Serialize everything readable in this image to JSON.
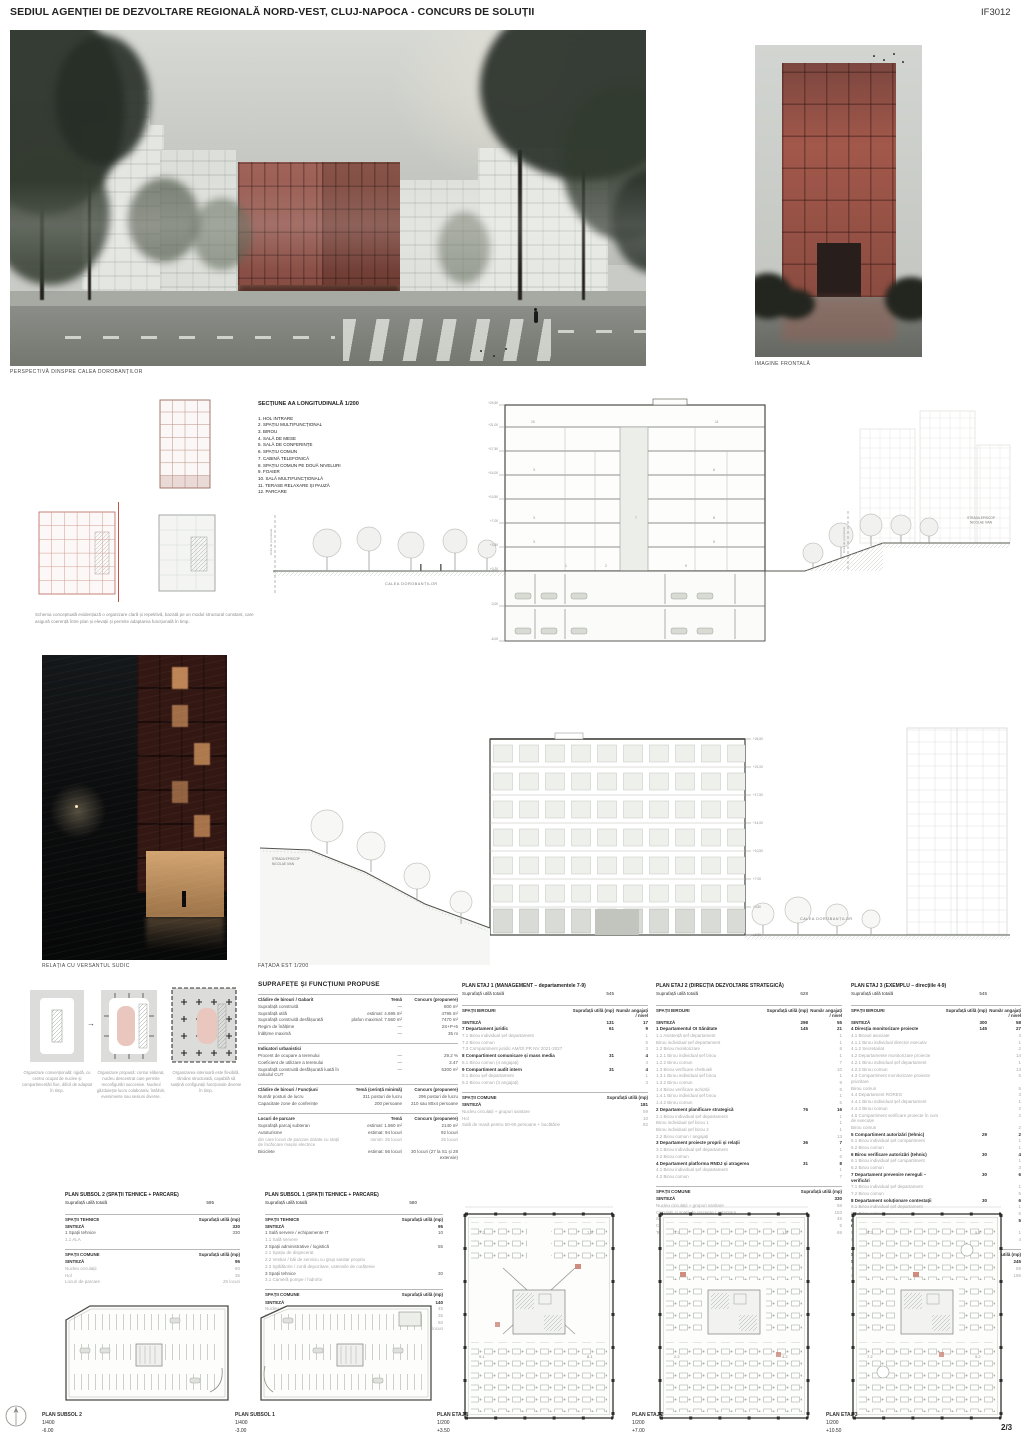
{
  "header": {
    "title": "SEDIUL AGENȚIEI DE DEZVOLTARE REGIONALĂ NORD-VEST, CLUJ-NAPOCA - CONCURS DE SOLUȚII",
    "code": "IF3012"
  },
  "captions": {
    "perspective": "PERSPECTIVĂ DINSPRE CALEA DOROBANȚILOR",
    "frontal": "IMAGINE FRONTALĂ",
    "versant": "RELAȚIA CU VERSANTUL SUDIC",
    "fatada": "FAȚADA EST 1/200"
  },
  "palette": {
    "brick_red": "#8e4a3e",
    "brick_red_front": "#a2584b",
    "night_window": "#bd8455",
    "drawing_grey": "#55584f",
    "schema_red": "#c0746a",
    "diagram_pink": "#e9c7be"
  },
  "section": {
    "title": "SECȚIUNE AA LONGITUDINALĂ 1/200",
    "legend": [
      "1. HOL INTRARE",
      "2. SPAȚIU MULTIFUNCȚIONAL",
      "3. BIROU",
      "4. SALĂ DE MESE",
      "5. SALĂ DE CONFERINȚE",
      "6. SPAȚIU COMUN",
      "7. CABINĂ TELEFONICĂ",
      "8. SPAȚIU COMUN PE DOUĂ NIVELURI",
      "9. FOAIER",
      "10. SALĂ MULTIFUNCȚIONALĂ",
      "11. TERASE RELAXARE ȘI PAUZĂ",
      "12. PARCARE"
    ],
    "street_left": "CALEA DOROBANȚILOR",
    "street_right_l1": "STRADA EPISCOP",
    "street_right_l2": "NICOLAE IVAN",
    "property_label": "limită de proprietate",
    "levels": [
      "+24,50",
      "+21,00",
      "+17,50",
      "+14,00",
      "+10,50",
      "+7,00",
      "+3,50",
      "+0,20",
      "-3,00",
      "-6,00"
    ]
  },
  "facade": {
    "street_left_l1": "STRADA EPISCOP",
    "street_left_l2": "NICOLAE IVAN",
    "street_right": "CALEA DOROBANȚILOR",
    "levels": [
      "+24,50",
      "+21,00",
      "+17,50",
      "+14,00",
      "+10,50",
      "+7,00",
      "+3,50",
      "±0,00"
    ]
  },
  "concept_text": "Schema conceptuală evidențiază o organizare clară și repetitivă, bazată pe un modul structural constant, care asigură coerență între plan și elevații și permite adaptarea funcțională în timp.",
  "diagrams": {
    "d1": "Organizare convențională: rigidă, cu centru ocupat de nuclee și compartimentări fixe, dificil de adaptat în timp.",
    "d2": "Organizare propusă: contur eliberat, nucleu descentrat care permite reconfigurări succesive. Nucleul găzduiește lucru colaborativ, întâlniri, evenimente sau sesiuni diverse.",
    "d3": "Organizarea interioară este flexibilă, rămâne structurată, capabilă să susțină configurații funcționale diverse în timp."
  },
  "suprafete": {
    "title": "SUPRAFEȚE ȘI FUNCȚIUNI PROPUSE",
    "sections": [
      {
        "h": [
          "Clădire de birouri / Gabarit",
          "Temă",
          "Concurs (propunere)"
        ],
        "rows": [
          {
            "c": [
              "Suprafață construită",
              "—",
              "800 m²"
            ]
          },
          {
            "c": [
              "Suprafață utilă",
              "estimat: 4.695 m²",
              "4795 m²"
            ]
          },
          {
            "c": [
              "Suprafață construită desfășurată",
              "plafon maximal: 7.560 m²",
              "7470 m²"
            ]
          },
          {
            "c": [
              "Regim de înălțime",
              "—",
              "2S+P+6"
            ]
          },
          {
            "c": [
              "Înălțime maximă",
              "—",
              "35 m"
            ]
          }
        ]
      },
      {
        "h": [
          "Indicatori urbanistici",
          "",
          ""
        ],
        "rows": [
          {
            "c": [
              "Procent de ocupare a terenului",
              "—",
              "29.2 %"
            ]
          },
          {
            "c": [
              "Coeficient de utilizare a terenului",
              "—",
              "2.47"
            ]
          },
          {
            "c": [
              "Suprafață construită desfășurată luată în calculul CUT",
              "—",
              "6300 m²"
            ]
          }
        ]
      },
      {
        "h": [
          "Clădire de birouri / Funcțiuni",
          "Temă (cerință minimă)",
          "Concurs (propunere)"
        ],
        "rows": [
          {
            "c": [
              "Număr posturi de lucru",
              "311 posturi de lucru",
              "296 posturi de lucru"
            ]
          },
          {
            "c": [
              "Capacitate zone de conferințe",
              "200 persoane",
              "210 sau 80x4 persoane"
            ]
          }
        ]
      },
      {
        "h": [
          "Locuri de parcare",
          "Temă",
          "Concurs (propunere)"
        ],
        "rows": [
          {
            "c": [
              "Suprafață parcaj subteran",
              "estimat: 1.860 m²",
              "2140 m²"
            ]
          },
          {
            "c": [
              "Autoturisme",
              "estimat: 94 locuri",
              "92 locuri"
            ]
          },
          {
            "c": [
              "din care locuri de parcare dotate cu stații de încărcare mașini electrice",
              "minim: 25 locuri",
              "25 locuri"
            ],
            "dim": true
          },
          {
            "c": [
              "Biciclete",
              "estimat: 56 locuri",
              "30 locuri (27 la S1 și 28 extensie)"
            ]
          }
        ]
      }
    ]
  },
  "etaj1": {
    "title": "PLAN ETAJ 1 (MANAGEMENT – departamentele 7-9)",
    "total_label": "Suprafață utilă totală",
    "total": "545",
    "birouri_label": "SPAȚII BIROURI",
    "comune_label": "SPAȚII COMUNE",
    "col_mp": "Suprafață utilă (mp)",
    "col_nr": "Număr angajați / nivel",
    "birouri": [
      {
        "c": [
          "SINTEZĂ",
          "131",
          "17"
        ],
        "b": true
      },
      {
        "c": [
          "7 Departament juridic",
          "61",
          "9"
        ],
        "b": true
      },
      {
        "c": [
          "7.1 Birou individual șef departament",
          "",
          "1"
        ],
        "dim": true
      },
      {
        "c": [
          "7.2 Birou comun",
          "",
          "5"
        ],
        "dim": true
      },
      {
        "c": [
          "7.3 Compartiment juridic AM/OI PR NV 2021-2027",
          "",
          "3"
        ],
        "dim": true
      },
      {
        "c": [
          "8 Compartiment comunicare și mass media",
          "31",
          "4"
        ],
        "b": true
      },
      {
        "c": [
          "8.1 Birou comun (4 angajați)",
          "",
          "4"
        ],
        "dim": true
      },
      {
        "c": [
          "9 Compartiment audit intern",
          "31",
          "4"
        ],
        "b": true
      },
      {
        "c": [
          "9.1 Birou șef departament",
          "",
          "1"
        ],
        "dim": true
      },
      {
        "c": [
          "9.2 Birou comun (3 angajați)",
          "",
          "3"
        ],
        "dim": true
      }
    ],
    "comune": [
      {
        "c": [
          "SINTEZĂ",
          "181"
        ],
        "b": true
      },
      {
        "c": [
          "Nucleu circulații + grupuri sanitare",
          "59"
        ],
        "dim": true
      },
      {
        "c": [
          "Hol",
          "10"
        ],
        "dim": true
      },
      {
        "c": [
          "Sală de masă pentru 50-60 persoane + bucătărie",
          "82"
        ],
        "dim": true
      }
    ]
  },
  "etaj2": {
    "title": "PLAN ETAJ 2 (DIRECȚIA DEZVOLTARE STRATEGICĂ)",
    "total_label": "Suprafață utilă totală",
    "total": "628",
    "birouri_label": "SPAȚII BIROURI",
    "comune_label": "SPAȚII COMUNE",
    "col_mp": "Suprafață utilă (mp)",
    "col_nr": "Număr angajați / nivel",
    "birouri": [
      {
        "c": [
          "SINTEZĂ",
          "298",
          "55"
        ],
        "b": true
      },
      {
        "c": [
          "1 Departamentul OI Sănătate",
          "145",
          "21"
        ],
        "b": true
      },
      {
        "c": [
          "1.1 Asistență șef departament",
          "",
          "1"
        ],
        "dim": true
      },
      {
        "c": [
          "Birou individual șef departament",
          "",
          "1"
        ],
        "dim": true
      },
      {
        "c": [
          "1.2 Birou monitorizare",
          "",
          "8"
        ],
        "dim": true
      },
      {
        "c": [
          "1.2.1 Birou individual șef birou",
          "",
          "1"
        ],
        "dim": true
      },
      {
        "c": [
          "1.2.2 Birou comun",
          "",
          "7"
        ],
        "dim": true
      },
      {
        "c": [
          "1.3 Birou verificare cheltuieli",
          "",
          "10"
        ],
        "dim": true
      },
      {
        "c": [
          "1.3.1 Birou individual șef birou",
          "",
          "1"
        ],
        "dim": true
      },
      {
        "c": [
          "1.3.2 Birou comun",
          "",
          "9"
        ],
        "dim": true
      },
      {
        "c": [
          "1.4 Birou verificare achiziții",
          "",
          "6"
        ],
        "dim": true
      },
      {
        "c": [
          "1.4.1 Birou individual șef birou",
          "",
          "1"
        ],
        "dim": true
      },
      {
        "c": [
          "1.4.2 Birou comun",
          "",
          "5"
        ],
        "dim": true
      },
      {
        "c": [
          "2 Departament planificare strategică",
          "76",
          "16"
        ],
        "b": true
      },
      {
        "c": [
          "2.1 Birou individual șef departament",
          "",
          "1"
        ],
        "dim": true
      },
      {
        "c": [
          "Birou individual șef birou 1",
          "",
          "1"
        ],
        "dim": true
      },
      {
        "c": [
          "Birou individual șef birou 2",
          "",
          "1"
        ],
        "dim": true
      },
      {
        "c": [
          "2.2 Birou comun / angajați",
          "",
          "13"
        ],
        "dim": true
      },
      {
        "c": [
          "3 Departament proiecte proprii și relații",
          "36",
          "7"
        ],
        "b": true
      },
      {
        "c": [
          "3.1 Birou individual șef departament",
          "",
          "1"
        ],
        "dim": true
      },
      {
        "c": [
          "3.2 Birou comun",
          "",
          "6"
        ],
        "dim": true
      },
      {
        "c": [
          "4 Departament platforma RNDJ și atragerea",
          "31",
          "8"
        ],
        "b": true
      },
      {
        "c": [
          "4.1 Birou individual șef departament",
          "",
          "1"
        ],
        "dim": true
      },
      {
        "c": [
          "4.2 Birou comun",
          "",
          "7"
        ],
        "dim": true
      }
    ],
    "comune": [
      {
        "c": [
          "SINTEZĂ",
          "330"
        ],
        "b": true
      },
      {
        "c": [
          "Nucleu circulații + grupuri sanitare",
          "58"
        ],
        "dim": true
      },
      {
        "c": [
          "Circulații și spații de recreere / așteptare",
          "153"
        ],
        "dim": true
      },
      {
        "c": [
          "Săli de conferințe",
          "45"
        ],
        "dim": true
      },
      {
        "c": [
          "Cabine telefonice",
          "5"
        ],
        "dim": true
      },
      {
        "c": [
          "Terase",
          "69"
        ],
        "dim": true
      }
    ]
  },
  "etaj3": {
    "title": "PLAN ETAJ 3 (EXEMPLU – direcțiile 4-9)",
    "total_label": "Suprafață utilă totală",
    "total": "545",
    "birouri_label": "SPAȚII BIROURI",
    "comune_label": "SPAȚII COMUNE",
    "col_mp": "Suprafață utilă (mp)",
    "col_nr": "Număr angajați / nivel",
    "birouri": [
      {
        "c": [
          "SINTEZĂ",
          "300",
          "58"
        ],
        "b": true
      },
      {
        "c": [
          "4 Direcția monitorizare proiecte",
          "145",
          "27"
        ],
        "b": true
      },
      {
        "c": [
          "4.1 Birouri asociate",
          "",
          "3"
        ],
        "dim": true
      },
      {
        "c": [
          "4.1.1 Birou individual director executiv",
          "",
          "1"
        ],
        "dim": true
      },
      {
        "c": [
          "4.1.2 Secretariat",
          "",
          "2"
        ],
        "dim": true
      },
      {
        "c": [
          "4.2 Departamente monitorizare proiecte",
          "",
          "14"
        ],
        "dim": true
      },
      {
        "c": [
          "4.2.1 Birou individual șef departament",
          "",
          "1"
        ],
        "dim": true
      },
      {
        "c": [
          "4.2.2 Birou comun",
          "",
          "13"
        ],
        "dim": true
      },
      {
        "c": [
          "4.3 Compartiment monitorizare proiecte prioritare",
          "",
          "5"
        ],
        "dim": true
      },
      {
        "c": [
          "Birou comun",
          "",
          "5"
        ],
        "dim": true
      },
      {
        "c": [
          "4.4 Departament ROREG",
          "",
          "3"
        ],
        "dim": true
      },
      {
        "c": [
          "4.4.1 Birou individual șef departament",
          "",
          "1"
        ],
        "dim": true
      },
      {
        "c": [
          "4.4.2 Birou comun",
          "",
          "2"
        ],
        "dim": true
      },
      {
        "c": [
          "4.5 Compartiment verificare proiecte în curs de execuție",
          "",
          "2"
        ],
        "dim": true
      },
      {
        "c": [
          "Birou comun",
          "",
          "2"
        ],
        "dim": true
      },
      {
        "c": [
          "5 Compartiment autorizări (tehnic)",
          "29",
          "2"
        ],
        "b": true
      },
      {
        "c": [
          "5.1 Birou individual șef compartiment",
          "",
          "1"
        ],
        "dim": true
      },
      {
        "c": [
          "5.2 Birou comun",
          "",
          "1"
        ],
        "dim": true
      },
      {
        "c": [
          "6 Birou verificare autorizări (tehnic)",
          "30",
          "4"
        ],
        "b": true
      },
      {
        "c": [
          "6.1 Birou individual șef compartiment",
          "",
          "1"
        ],
        "dim": true
      },
      {
        "c": [
          "6.2 Birou comun",
          "",
          "3"
        ],
        "dim": true
      },
      {
        "c": [
          "7 Departament prevenire nereguli – verificări",
          "30",
          "6"
        ],
        "b": true
      },
      {
        "c": [
          "7.1 Birou individual șef departament",
          "",
          "1"
        ],
        "dim": true
      },
      {
        "c": [
          "7.2 Birou comun",
          "",
          "5"
        ],
        "dim": true
      },
      {
        "c": [
          "8 Departament soluționare contestații",
          "30",
          "6"
        ],
        "b": true
      },
      {
        "c": [
          "8.1 Birou individual șef departament",
          "",
          "1"
        ],
        "dim": true
      },
      {
        "c": [
          "8.2 Birou comun",
          "",
          "5"
        ],
        "dim": true
      },
      {
        "c": [
          "9 Compartiment nereguli și monitorizare măsuri",
          "31",
          "5"
        ],
        "b": true
      },
      {
        "c": [
          "9.1 Birou individual șef compartiment",
          "",
          "1"
        ],
        "dim": true
      },
      {
        "c": [
          "9.2 Birou comun",
          "",
          "4"
        ],
        "dim": true
      }
    ],
    "comune": [
      {
        "c": [
          "SINTEZĂ",
          "245"
        ],
        "b": true
      },
      {
        "c": [
          "Nucleu circulații + grupuri sanitare",
          "59"
        ],
        "dim": true
      },
      {
        "c": [
          "Circulații și spații de recreere / așteptare",
          "186"
        ],
        "dim": true
      }
    ]
  },
  "subsol2": {
    "title": "PLAN SUBSOL 2 (SPAȚII TEHNICE + PARCARE)",
    "total_label": "Suprafață utilă totală",
    "total": "595",
    "tehnice_label": "SPAȚII TEHNICE",
    "comune_label": "SPAȚII COMUNE",
    "col_mp": "Suprafață utilă (mp)",
    "tehnice": [
      {
        "c": [
          "SINTEZĂ",
          "330"
        ],
        "b": true
      },
      {
        "c": [
          "1 Spații tehnice",
          "330"
        ]
      },
      {
        "c": [
          "1.1 ALA",
          ""
        ],
        "dim": true
      }
    ],
    "comune": [
      {
        "c": [
          "SINTEZĂ",
          "95"
        ],
        "b": true
      },
      {
        "c": [
          "Nucleu circulații",
          "60"
        ],
        "dim": true
      },
      {
        "c": [
          "Hol",
          "35"
        ],
        "dim": true
      },
      {
        "c": [
          "Locuri de parcare",
          "25 locuri"
        ],
        "dim": true
      }
    ]
  },
  "subsol1": {
    "title": "PLAN SUBSOL 1 (SPAȚII TEHNICE + PARCARE)",
    "total_label": "Suprafață utilă totală",
    "total": "580",
    "tehnice_label": "SPAȚII TEHNICE",
    "comune_label": "SPAȚII COMUNE",
    "col_mp": "Suprafață utilă (mp)",
    "tehnice": [
      {
        "c": [
          "SINTEZĂ",
          "95"
        ],
        "b": true
      },
      {
        "c": [
          "1 Sală servere / echipamente IT",
          "10"
        ]
      },
      {
        "c": [
          "1.1 Sală servere",
          ""
        ],
        "dim": true
      },
      {
        "c": [
          "2 Spații administrative / logistică",
          "55"
        ]
      },
      {
        "c": [
          "2.1 Spațiu de dispecerat",
          ""
        ],
        "dim": true
      },
      {
        "c": [
          "2.2 Vestiar / băi de serviciu cu grup sanitar propriu",
          ""
        ],
        "dim": true
      },
      {
        "c": [
          "2.3 Spălătorie / zonă depozitare, ustensile de curățenie",
          ""
        ],
        "dim": true
      },
      {
        "c": [
          "3 Spații tehnice",
          "30"
        ]
      },
      {
        "c": [
          "3.1 Cameră pompe / hidrofor",
          ""
        ],
        "dim": true
      }
    ],
    "comune": [
      {
        "c": [
          "SINTEZĂ",
          "140"
        ],
        "b": true
      },
      {
        "c": [
          "Nucleu circulații",
          "45"
        ],
        "dim": true
      },
      {
        "c": [
          "Hol",
          "35"
        ],
        "dim": true
      },
      {
        "c": [
          "Parcare biciclete",
          "60"
        ],
        "dim": true
      },
      {
        "c": [
          "Locuri de parcare",
          "27 locuri"
        ],
        "dim": true
      }
    ]
  },
  "plan_tags": {
    "e1": [
      "7.2",
      "7.3",
      "9.1",
      "8.1"
    ],
    "e2": [
      "1.2",
      "1.3",
      "2.2",
      "4.2"
    ],
    "e3": [
      "4.2",
      "5.1",
      "7.2",
      "9.2"
    ]
  },
  "plans": [
    {
      "name": "PLAN SUBSOL 2",
      "scale": "1/400",
      "level": "-6.00"
    },
    {
      "name": "PLAN SUBSOL 1",
      "scale": "1/400",
      "level": "-3.00"
    },
    {
      "name": "PLAN ETAJ 1",
      "scale": "1/200",
      "level": "+3.50"
    },
    {
      "name": "PLAN ETAJ 2",
      "scale": "1/200",
      "level": "+7.00"
    },
    {
      "name": "PLAN ETAJ 3",
      "scale": "1/200",
      "level": "+10.50"
    }
  ],
  "page": "2/3"
}
